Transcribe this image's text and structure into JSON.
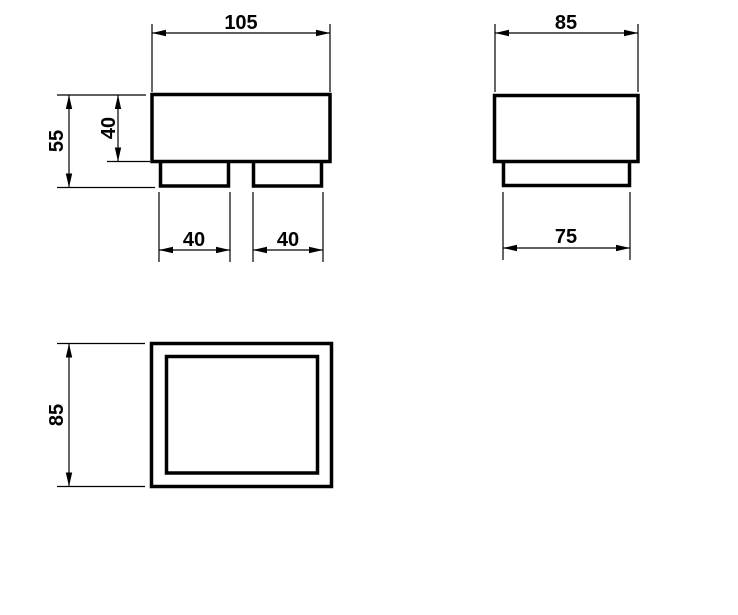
{
  "drawing": {
    "background_color": "#ffffff",
    "line_color": "#000000",
    "views": {
      "front": {
        "dims": {
          "width": "105",
          "total_height": "55",
          "body_height": "40",
          "left_foot_width": "40",
          "right_foot_width": "40"
        }
      },
      "side": {
        "dims": {
          "width": "85",
          "base_width": "75"
        }
      },
      "plan": {
        "dims": {
          "depth": "85"
        }
      }
    }
  }
}
